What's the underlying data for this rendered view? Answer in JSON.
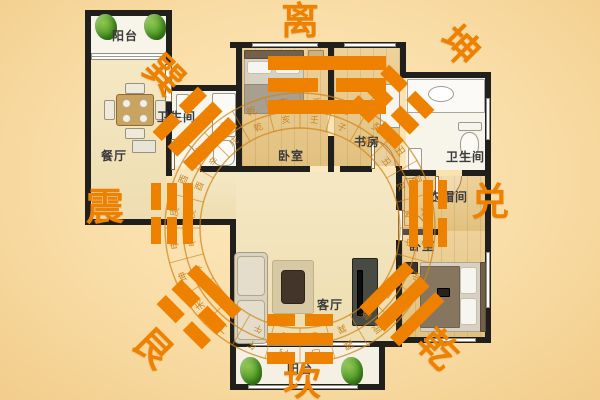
{
  "background": {
    "center": "#fdeac2",
    "mid": "#f9dda6",
    "edge": "#f2cd8c"
  },
  "accent": {
    "orange": "#ee8200",
    "ring": "#cf8318",
    "wall": "#211f1c"
  },
  "bagua": {
    "directions": [
      {
        "name": "li",
        "char": "离",
        "position": "top"
      },
      {
        "name": "kun",
        "char": "坤",
        "position": "top-right"
      },
      {
        "name": "dui",
        "char": "兑",
        "position": "right"
      },
      {
        "name": "qian",
        "char": "乾",
        "position": "bottom-right"
      },
      {
        "name": "kan",
        "char": "坎",
        "position": "bottom"
      },
      {
        "name": "gen",
        "char": "艮",
        "position": "bottom-left"
      },
      {
        "name": "zhen",
        "char": "震",
        "position": "left"
      },
      {
        "name": "xun",
        "char": "巽",
        "position": "top-left"
      }
    ],
    "trigrams": {
      "li": {
        "orientation": "h",
        "lines": [
          "solid",
          "broken",
          "solid"
        ]
      },
      "kan": {
        "orientation": "h",
        "lines": [
          "broken",
          "solid",
          "broken"
        ]
      },
      "zhen": {
        "orientation": "v",
        "lines": [
          "broken",
          "broken",
          "solid"
        ]
      },
      "dui": {
        "orientation": "v",
        "lines": [
          "solid",
          "solid",
          "broken"
        ]
      },
      "xun": {
        "orientation": "h",
        "lines": [
          "broken",
          "solid",
          "solid"
        ]
      },
      "kun": {
        "orientation": "h",
        "lines": [
          "broken",
          "broken",
          "broken"
        ]
      },
      "gen": {
        "orientation": "h",
        "lines": [
          "solid",
          "broken",
          "broken"
        ]
      },
      "qian": {
        "orientation": "h",
        "lines": [
          "solid",
          "solid",
          "solid"
        ]
      }
    }
  },
  "rooms": [
    {
      "label": "阳台"
    },
    {
      "label": "餐厅"
    },
    {
      "label": "卫生间"
    },
    {
      "label": "卧室"
    },
    {
      "label": "书房"
    },
    {
      "label": "卫生间"
    },
    {
      "label": "衣帽间"
    },
    {
      "label": "卧室"
    },
    {
      "label": "客厅"
    },
    {
      "label": "阳台"
    }
  ],
  "luopan": {
    "ring_chars": [
      "壬",
      "子",
      "癸",
      "丑",
      "艮",
      "寅",
      "甲",
      "卯",
      "乙",
      "辰",
      "巽",
      "巳",
      "丙",
      "午",
      "丁",
      "未",
      "坤",
      "申",
      "庚",
      "酉",
      "辛",
      "戌",
      "乾",
      "亥"
    ]
  }
}
